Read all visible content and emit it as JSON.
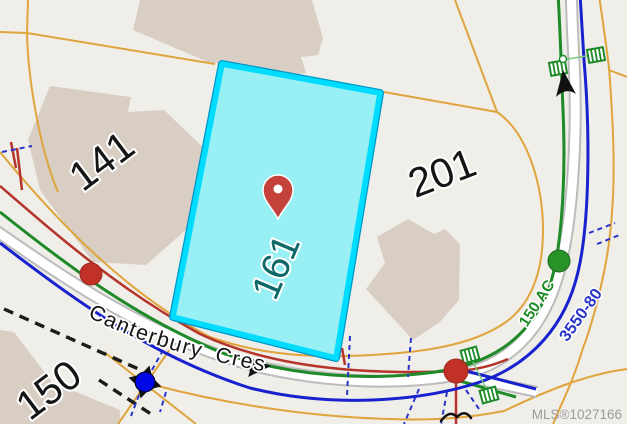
{
  "map": {
    "watermark": "MLS®1027166",
    "street": {
      "name": "Canterbury Cres"
    },
    "roads": {
      "green_label": "150 AC",
      "blue_label": "3550-80"
    },
    "parcels": {
      "p141": {
        "label": "141"
      },
      "p201": {
        "label": "201"
      },
      "p150": {
        "label": "150"
      },
      "highlighted": {
        "label": "161"
      }
    }
  },
  "colors": {
    "background": "#F0EEE9",
    "building": "#D8CEC3",
    "parcel_line_orange": "#DFA43C",
    "highlight_fill": "#98F0F4",
    "highlight_border": "#00DCFF",
    "highlight_border_edge": "#0095C8",
    "highlight_label": "#0E6968",
    "utility_red": "#B5352C",
    "utility_green": "#1E8A28",
    "utility_blue": "#1722CE",
    "dashed_blue": "#2A35C8",
    "dashed_black": "#1B1B1B",
    "road_casing": "#BCBCBC",
    "road_fill": "#FFFFFF",
    "node_red": "#C23128",
    "node_green": "#279327",
    "node_blue": "#0009E5",
    "pin_red": "#C4423A",
    "watermark_gray": "#9C9C9C",
    "label_black": "#151515"
  }
}
